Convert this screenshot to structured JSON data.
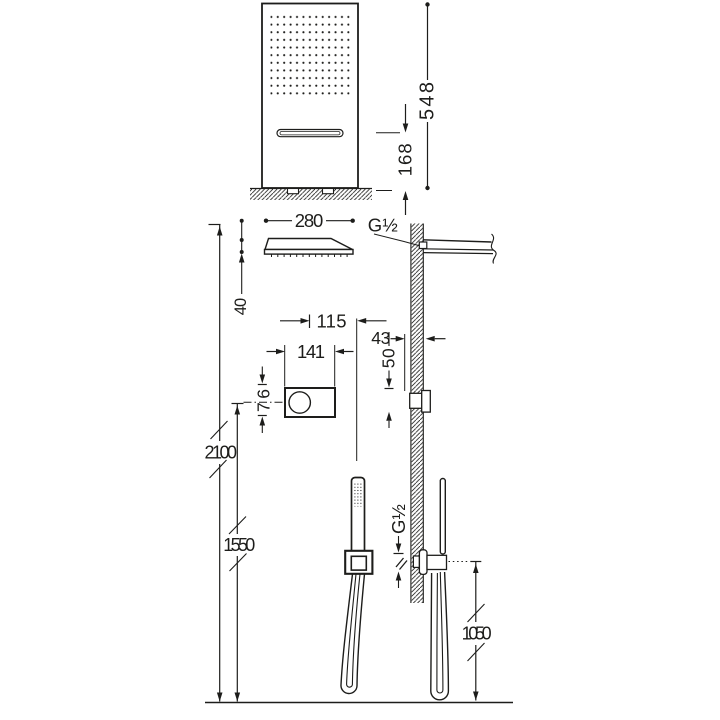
{
  "drawing_type": "shower-system-installation-dimension-drawing",
  "colors": {
    "line": "#1d1d1b",
    "background": "#ffffff"
  },
  "labels": {
    "dim_548": "548",
    "dim_168": "168",
    "dim_280": "280",
    "thread_top": "G½",
    "dim_40": "40",
    "dim_115": "115",
    "dim_141": "141",
    "dim_43": "43",
    "dim_50": "50",
    "dim_76": "76",
    "dim_2100": "2100",
    "dim_1550": "1550",
    "thread_bottom": "G½",
    "dim_1050": "1050"
  }
}
